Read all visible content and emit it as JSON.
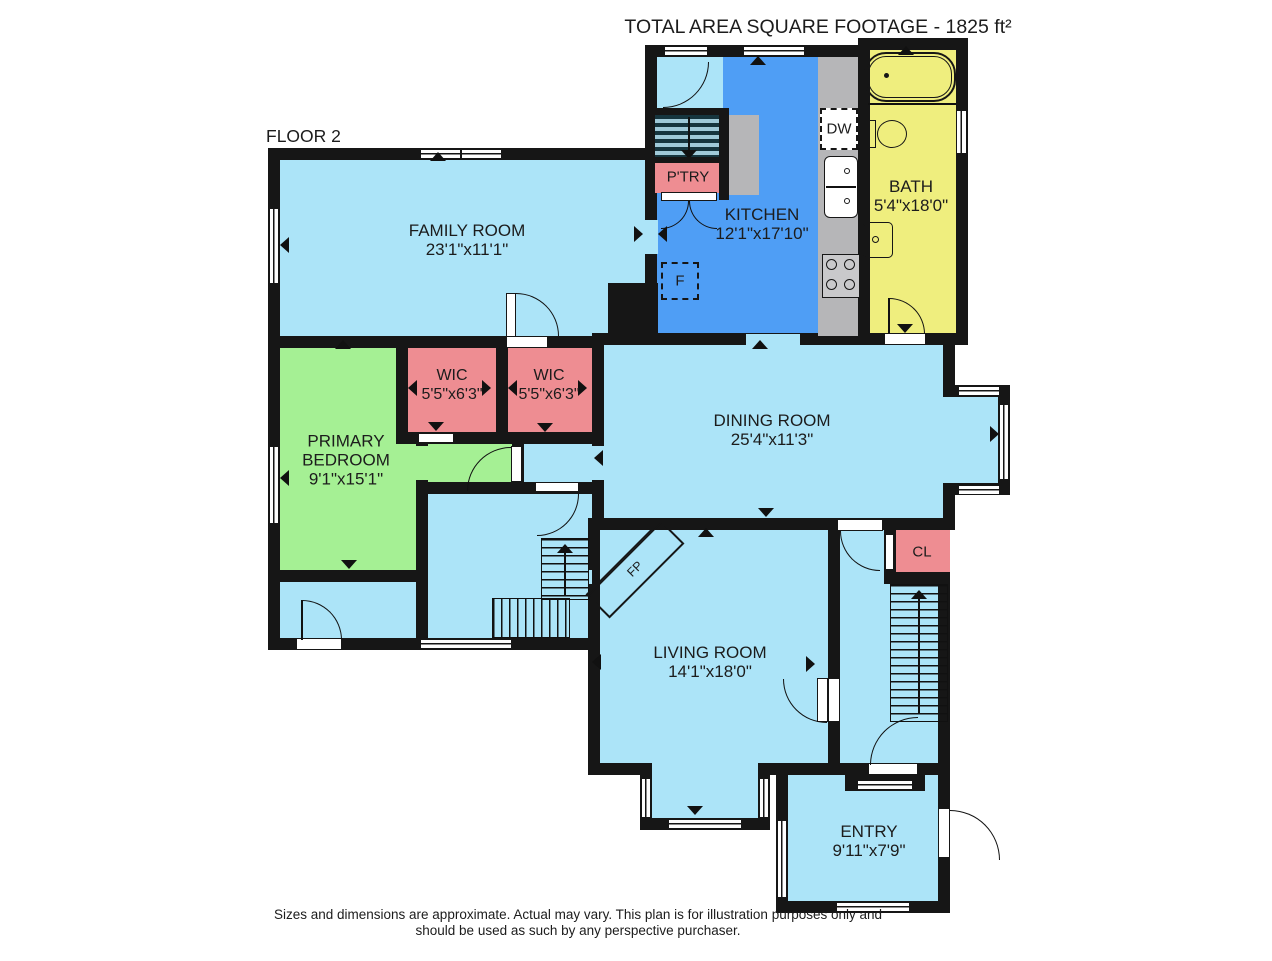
{
  "title": "TOTAL AREA SQUARE FOOTAGE - 1825 ft²",
  "floor_label": "FLOOR 2",
  "rooms": {
    "family": {
      "name": "FAMILY ROOM",
      "dims": "23'1\"x11'1\""
    },
    "kitchen": {
      "name": "KITCHEN",
      "dims": "12'1\"x17'10\""
    },
    "bath": {
      "name": "BATH",
      "dims": "5'4\"x18'0\""
    },
    "pantry": {
      "name": "P'TRY"
    },
    "wic1": {
      "name": "WIC",
      "dims": "5'5\"x6'3\""
    },
    "wic2": {
      "name": "WIC",
      "dims": "5'5\"x6'3\""
    },
    "primary_bedroom": {
      "name_line1": "PRIMARY",
      "name_line2": "BEDROOM",
      "dims": "9'1\"x15'1\""
    },
    "dining": {
      "name": "DINING ROOM",
      "dims": "25'4\"x11'3\""
    },
    "living": {
      "name": "LIVING ROOM",
      "dims": "14'1\"x18'0\""
    },
    "closet": {
      "name": "CL"
    },
    "entry": {
      "name": "ENTRY",
      "dims": "9'11\"x7'9\""
    }
  },
  "fixtures": {
    "dishwasher": "DW",
    "fridge": "F",
    "fireplace": "FP"
  },
  "disclaimer_line1": "Sizes and dimensions are approximate. Actual may vary. This plan is for illustration purposes only and",
  "disclaimer_line2": "should be used as such by any perspective purchaser.",
  "colors": {
    "wall": "#161616",
    "room_light_blue": "#ace4f8",
    "kitchen_blue": "#4f9ef5",
    "bath_yellow": "#efee7e",
    "bedroom_green": "#a5f094",
    "closet_salmon": "#ee8d92",
    "counter_gray": "#b6b6b8",
    "stair_stripe": "#16353e"
  }
}
